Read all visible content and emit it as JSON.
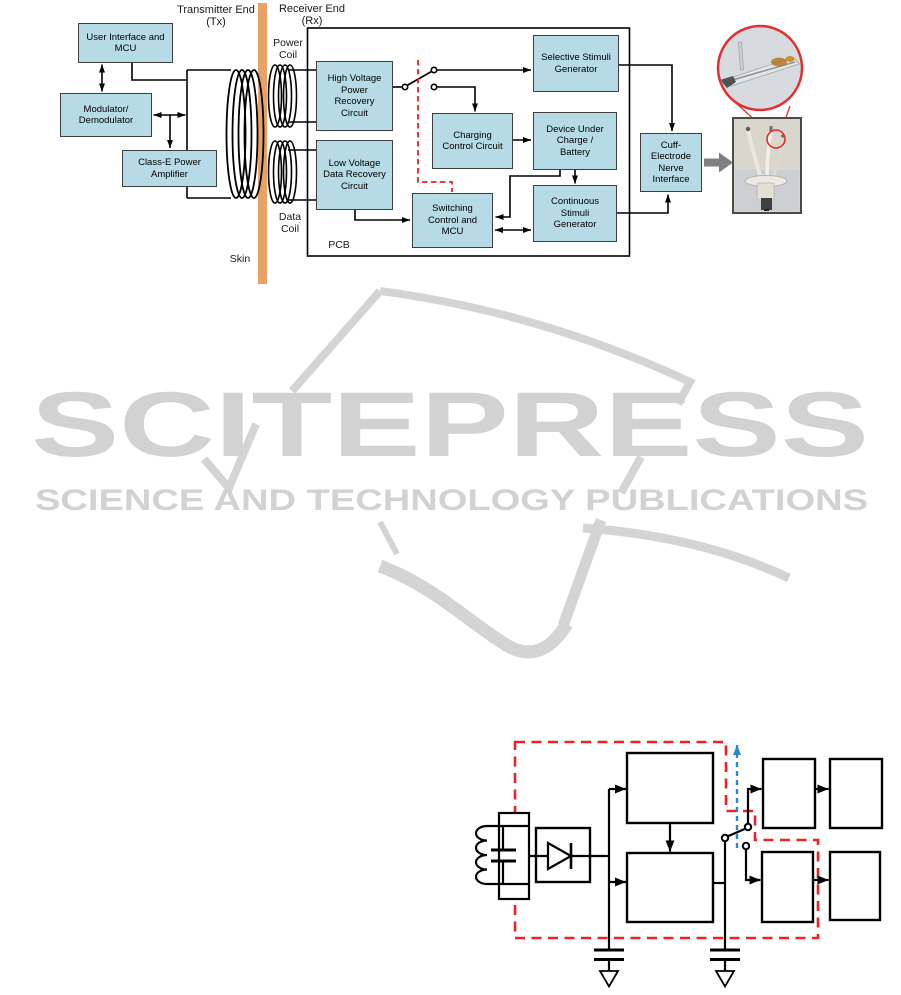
{
  "watermark": {
    "wordmark": "SCITEPRESS",
    "tagline": "SCIENCE AND TECHNOLOGY PUBLICATIONS",
    "color": "#d2d2d2"
  },
  "colors": {
    "block_fill": "#b7dbe6",
    "block_border": "#3f3f3f",
    "skin_bar": "#e9a266",
    "wire_black": "#000000",
    "dashed_control_red": "#ee2222",
    "dashed_control_blue": "#2e86c8",
    "photo_highlight_red": "#e03030",
    "gray_arrow": "#808080",
    "watermark_gray": "#d2d2d2"
  },
  "figure_block_diagram": {
    "labels": {
      "transmitter_end": "Transmitter End (Tx)",
      "receiver_end": "Receiver End (Rx)",
      "power_coil": "Power Coil",
      "data_coil": "Data Coil",
      "skin": "Skin",
      "pcb": "PCB"
    },
    "tx_blocks": [
      {
        "id": "user-interface-mcu",
        "label": "User Interface and MCU"
      },
      {
        "id": "modulator-demodulator",
        "label": "Modulator/ Demodulator"
      },
      {
        "id": "class-e-power-amplifier",
        "label": "Class-E Power Amplifier"
      }
    ],
    "rx_blocks": [
      {
        "id": "high-voltage-power-recovery",
        "label": "High Voltage Power Recovery Circuit"
      },
      {
        "id": "low-voltage-data-recovery",
        "label": "Low Voltage Data Recovery Circuit"
      },
      {
        "id": "charging-control",
        "label": "Charging Control Circuit"
      },
      {
        "id": "switching-control-mcu",
        "label": "Switching Control and MCU"
      },
      {
        "id": "selective-stimuli-generator",
        "label": "Selective Stimuli Generator"
      },
      {
        "id": "device-under-charge",
        "label": "Device Under Charge / Battery"
      },
      {
        "id": "continuous-stimuli-generator",
        "label": "Continuous Stimuli Generator"
      },
      {
        "id": "cuff-electrode-nerve-interface",
        "label": "Cuff-Electrode Nerve Interface"
      }
    ]
  },
  "figure_circuit_schematic": {
    "description_boxes_empty": true,
    "outline_color": "#ee2222",
    "control_line_color": "#2e86c8"
  }
}
